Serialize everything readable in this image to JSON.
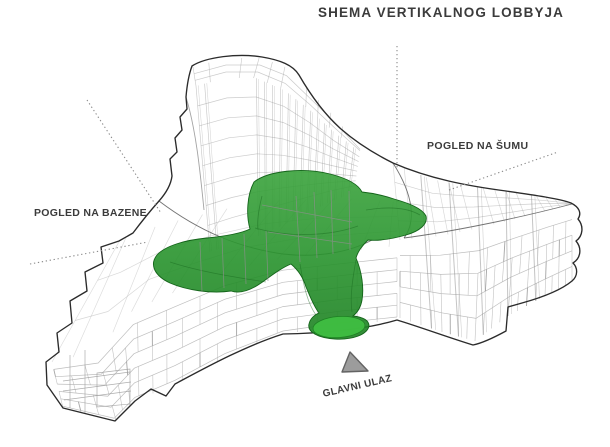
{
  "title": "SHEMA VERTIKALNOG LOBBYJA",
  "labels": {
    "forest_view": "POGLED NA ŠUMU",
    "pools_view": "POGLED NA BAZENE",
    "main_entrance": "GLAVNI ULAZ"
  },
  "legend": {
    "highlighted_volume": "vertical lobby (green translucent form inside wireframe building)"
  },
  "colors": {
    "text": "#3b3b3b",
    "lobby-green": "#27922c",
    "lobby-green-top": "#3aa33c",
    "lobby-green-deep": "#1d8122",
    "lobby-green-dark": "#14641a",
    "lobby-green-light": "#3fbe41",
    "outline": "#2b2b2b",
    "wire-light": "#b3b3b3",
    "wire-mid": "#9c9c9c",
    "annotation-dotted": "#8a8a8a",
    "triangle-fill": "#9c9c9c",
    "triangle-stroke": "#636363"
  }
}
